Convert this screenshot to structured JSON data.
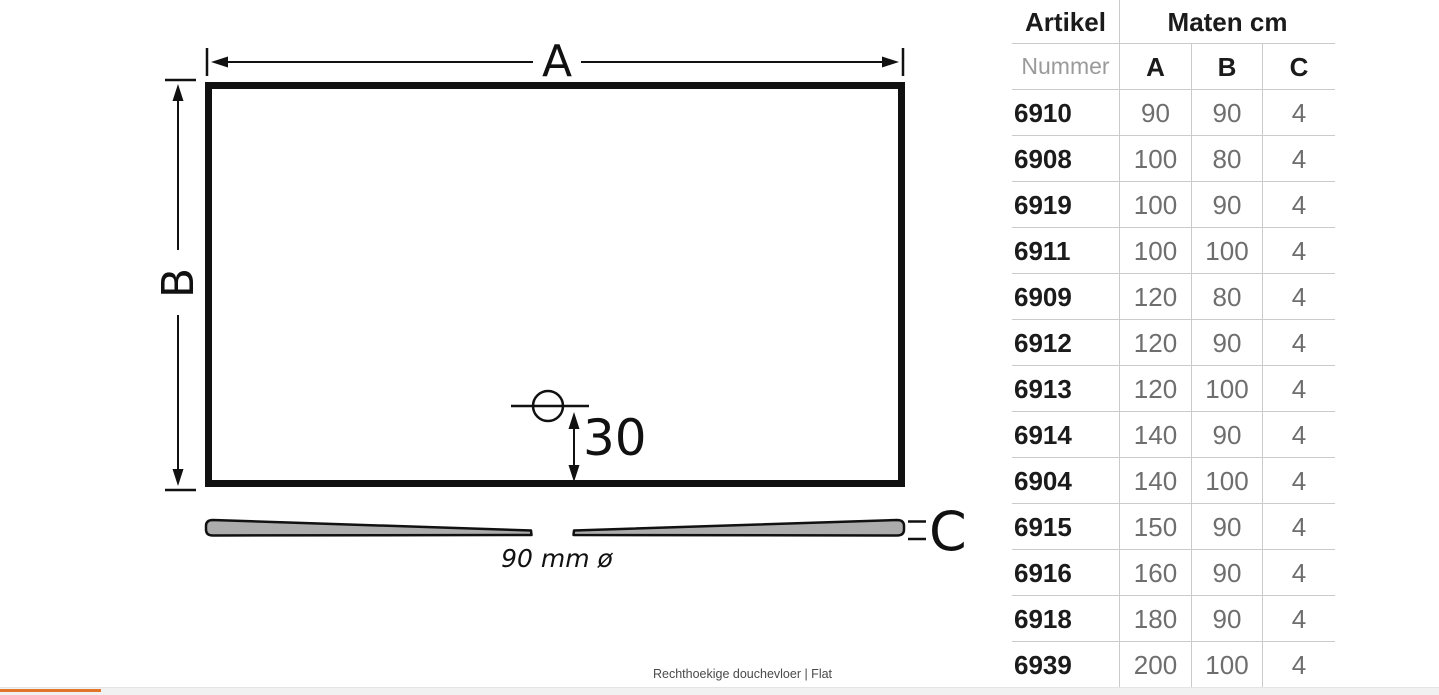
{
  "page": {
    "caption": "Rechthoekige douchevloer | Flat"
  },
  "diagram": {
    "width_label": "A",
    "height_label": "B",
    "thickness_label": "C",
    "drain_offset": "30",
    "drain_diameter": "90 mm ø"
  },
  "table": {
    "header": {
      "artikel": "Artikel",
      "maten": "Maten cm"
    },
    "subheader": {
      "nummer": "Nummer",
      "a": "A",
      "b": "B",
      "c": "C"
    },
    "rows": [
      {
        "artikel": "6910",
        "a": "90",
        "b": "90",
        "c": "4"
      },
      {
        "artikel": "6908",
        "a": "100",
        "b": "80",
        "c": "4"
      },
      {
        "artikel": "6919",
        "a": "100",
        "b": "90",
        "c": "4"
      },
      {
        "artikel": "6911",
        "a": "100",
        "b": "100",
        "c": "4"
      },
      {
        "artikel": "6909",
        "a": "120",
        "b": "80",
        "c": "4"
      },
      {
        "artikel": "6912",
        "a": "120",
        "b": "90",
        "c": "4"
      },
      {
        "artikel": "6913",
        "a": "120",
        "b": "100",
        "c": "4"
      },
      {
        "artikel": "6914",
        "a": "140",
        "b": "90",
        "c": "4"
      },
      {
        "artikel": "6904",
        "a": "140",
        "b": "100",
        "c": "4"
      },
      {
        "artikel": "6915",
        "a": "150",
        "b": "90",
        "c": "4"
      },
      {
        "artikel": "6916",
        "a": "160",
        "b": "90",
        "c": "4"
      },
      {
        "artikel": "6918",
        "a": "180",
        "b": "90",
        "c": "4"
      },
      {
        "artikel": "6939",
        "a": "200",
        "b": "100",
        "c": "4"
      }
    ]
  },
  "colors": {
    "ink": "#111111",
    "accent_orange": "#E0752B",
    "table_line": "#CBCBCB",
    "value_text": "#6E6E6E",
    "muted_text": "#9A9A9A",
    "wedge_fill": "#ACACAC",
    "footer_bar_bg": "#F1F1F1"
  }
}
